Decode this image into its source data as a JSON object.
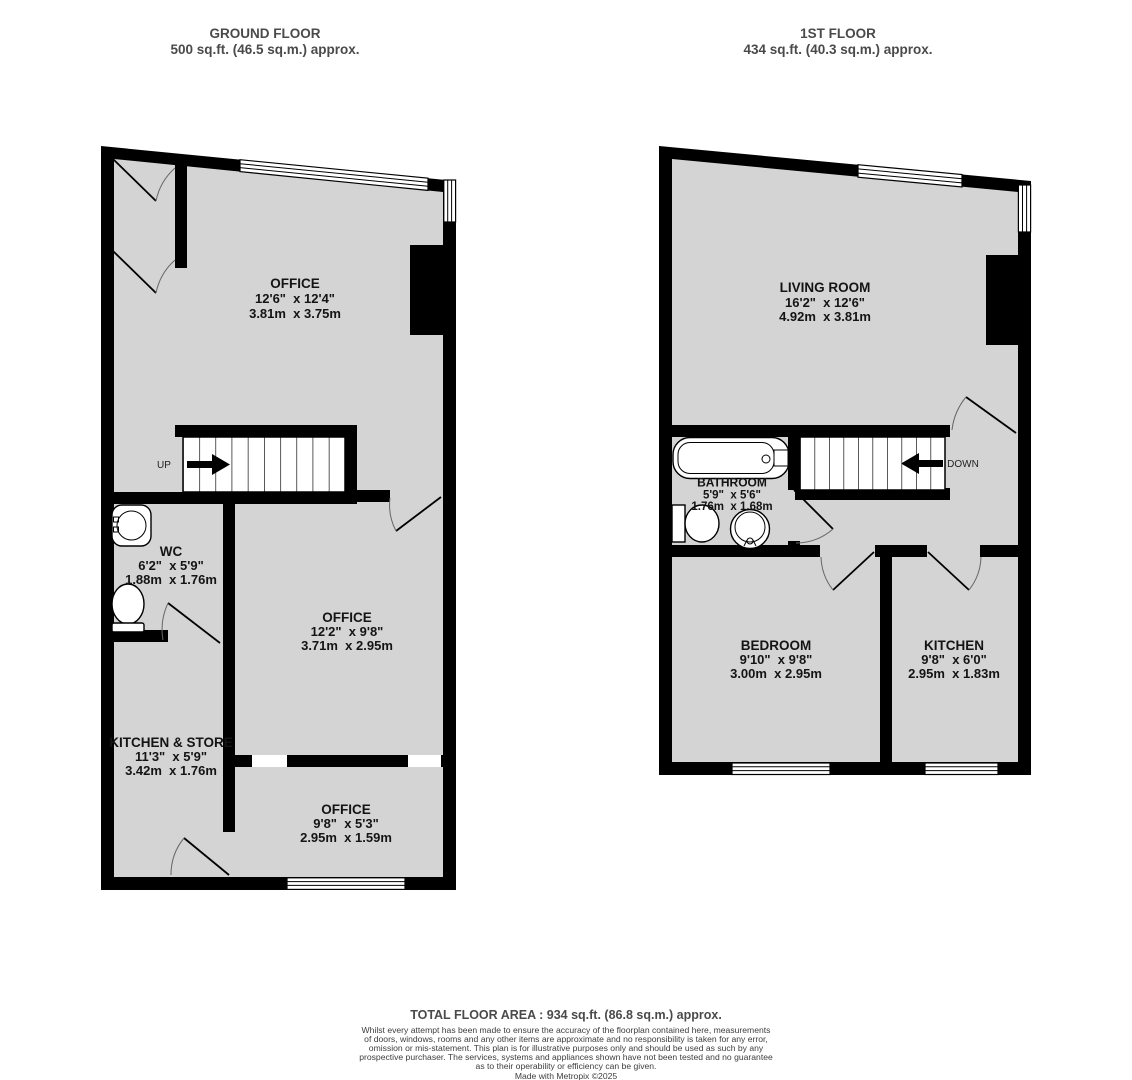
{
  "ground_floor": {
    "title": "GROUND FLOOR",
    "subtitle": "500 sq.ft. (46.5 sq.m.) approx.",
    "stairs_direction": "UP",
    "rooms": {
      "office_top": {
        "name": "OFFICE",
        "imperial": "12'6\"  x 12'4\"",
        "metric": "3.81m  x 3.75m"
      },
      "wc": {
        "name": "WC",
        "imperial": "6'2\"  x 5'9\"",
        "metric": "1.88m  x 1.76m"
      },
      "office_middle": {
        "name": "OFFICE",
        "imperial": "12'2\"  x 9'8\"",
        "metric": "3.71m  x 2.95m"
      },
      "kitchen_store": {
        "name": "KITCHEN & STORE",
        "imperial": "11'3\"  x 5'9\"",
        "metric": "3.42m  x 1.76m"
      },
      "office_bottom": {
        "name": "OFFICE",
        "imperial": "9'8\"  x 5'3\"",
        "metric": "2.95m  x 1.59m"
      }
    }
  },
  "first_floor": {
    "title": "1ST FLOOR",
    "subtitle": "434 sq.ft. (40.3 sq.m.) approx.",
    "stairs_direction": "DOWN",
    "rooms": {
      "living_room": {
        "name": "LIVING ROOM",
        "imperial": "16'2\"  x 12'6\"",
        "metric": "4.92m  x 3.81m"
      },
      "bathroom": {
        "name": "BATHROOM",
        "imperial": "5'9\"  x 5'6\"",
        "metric": "1.76m  x 1.68m"
      },
      "bedroom": {
        "name": "BEDROOM",
        "imperial": "9'10\"  x 9'8\"",
        "metric": "3.00m  x 2.95m"
      },
      "kitchen": {
        "name": "KITCHEN",
        "imperial": "9'8\"  x 6'0\"",
        "metric": "2.95m  x 1.83m"
      }
    }
  },
  "footer": {
    "total_area": "TOTAL FLOOR AREA : 934 sq.ft. (86.8 sq.m.) approx.",
    "disclaimer": [
      "Whilst every attempt has been made to ensure the accuracy of the floorplan contained here, measurements",
      "of doors, windows, rooms and any other items are approximate and no responsibility is taken for any error,",
      "omission or mis-statement. This plan is for illustrative purposes only and should be used as such by any",
      "prospective purchaser. The services, systems and appliances shown have not been tested and no guarantee",
      "as to their operability or efficiency can be given."
    ],
    "credit": "Made with Metropix ©2025"
  },
  "colors": {
    "floor_fill": "#d4d4d4",
    "wall": "#000000",
    "label_text": "#141414",
    "heading_text": "#4a4a4a"
  }
}
